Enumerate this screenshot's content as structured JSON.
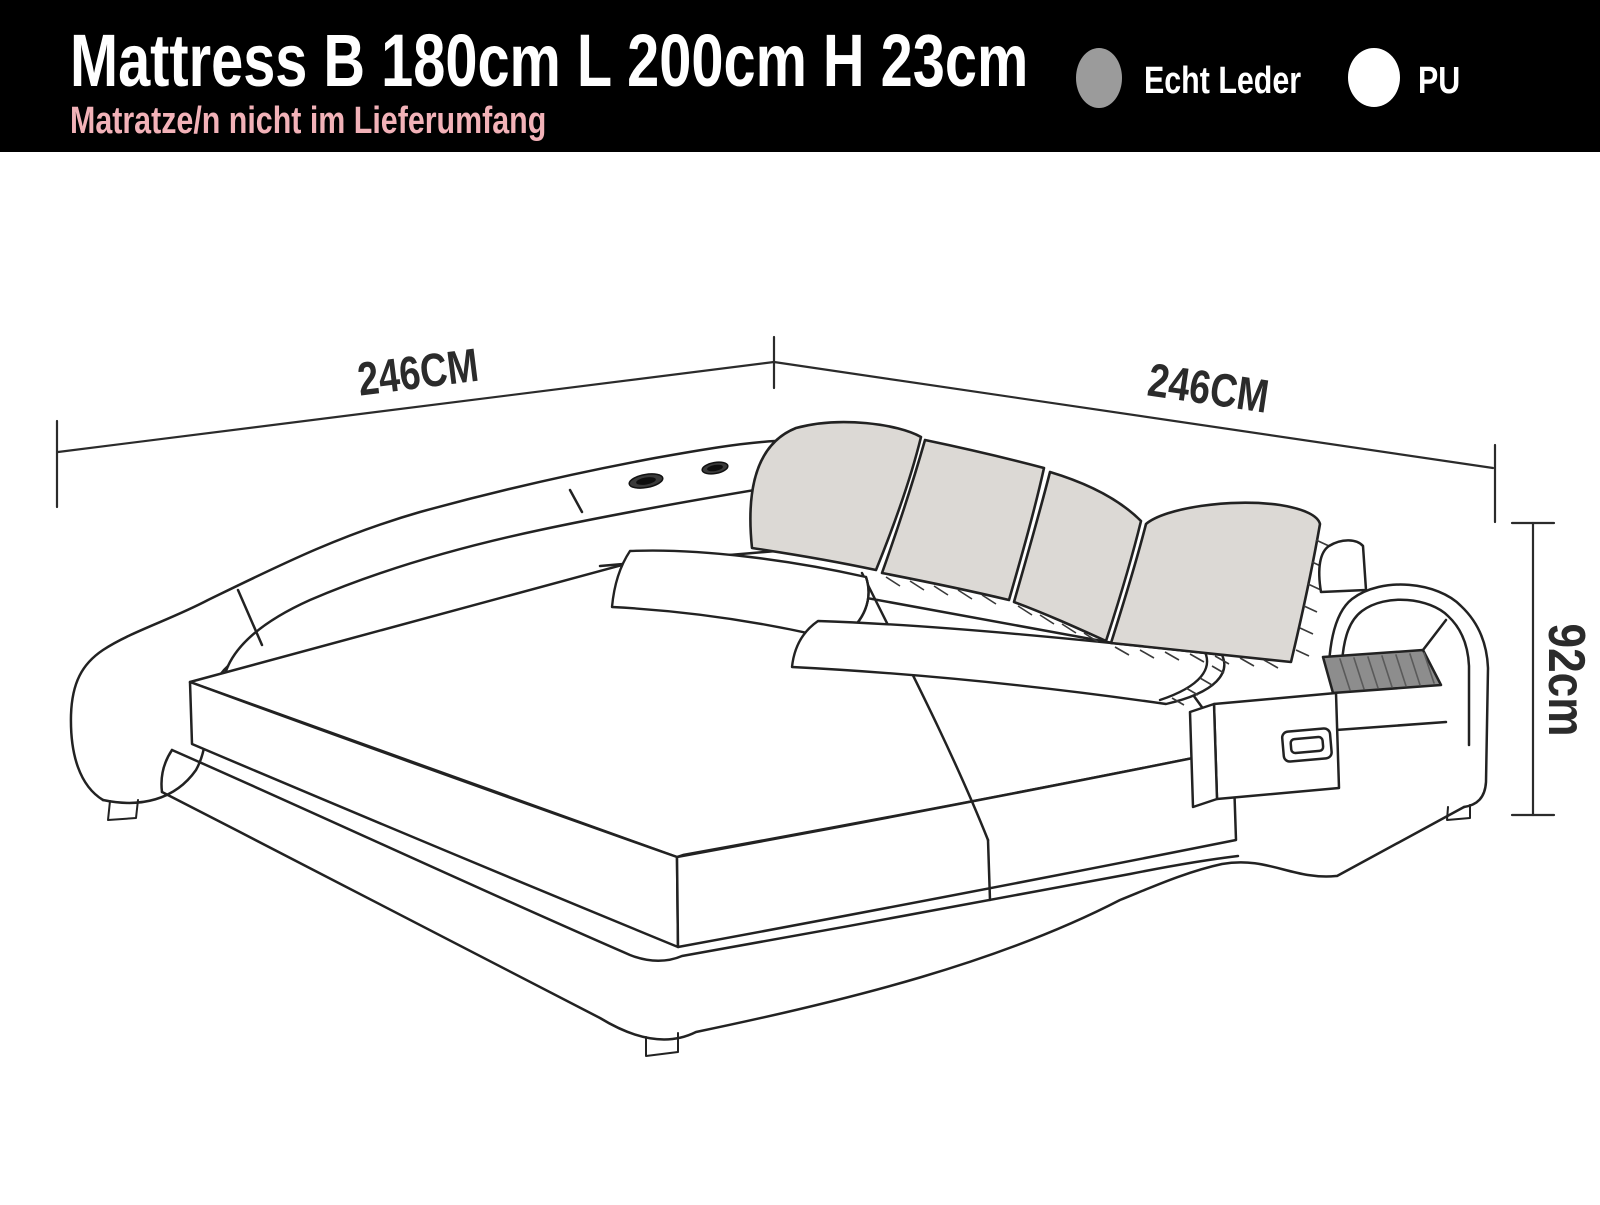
{
  "header": {
    "title": "Mattress B 180cm L 200cm H 23cm",
    "subtitle": "Matratze/n nicht im Lieferumfang",
    "title_color": "#ffffff",
    "subtitle_color": "#f2b2b8",
    "background": "#000000",
    "legend": [
      {
        "label": "Echt Leder",
        "swatch_color": "#9b9b9b"
      },
      {
        "label": "PU",
        "swatch_color": "#ffffff"
      }
    ]
  },
  "diagram": {
    "subject": "leather platform bed with curved side rail, spotlight shelf, headboard cushions and integrated nightstand",
    "dimensions": {
      "left_width": {
        "label": "246CM"
      },
      "right_width": {
        "label": "246CM"
      },
      "height": {
        "label": "92cm"
      }
    },
    "colors": {
      "line": "#222222",
      "cushion_fill": "#dcd9d5",
      "shelf_fill": "#8d8d8d",
      "background": "#ffffff"
    }
  }
}
